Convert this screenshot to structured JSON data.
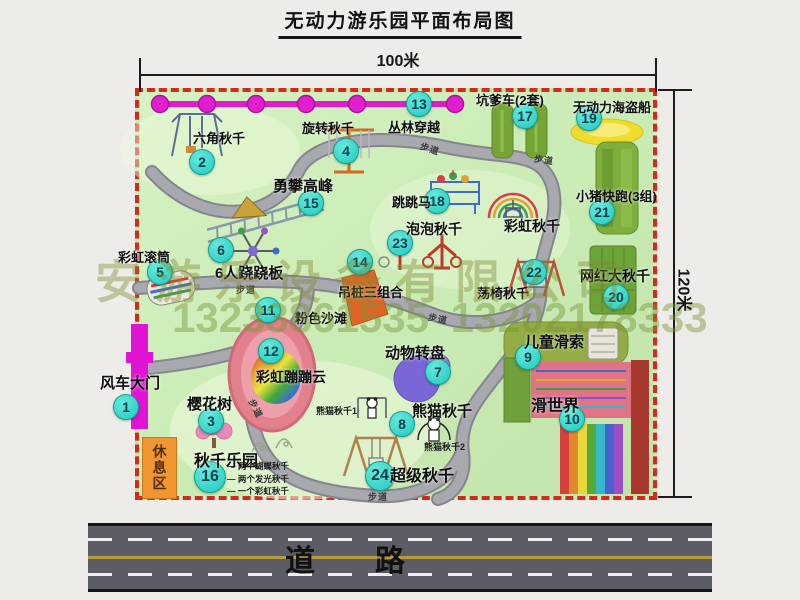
{
  "title": "无动力游乐园平面布局图",
  "dim_top": "100米",
  "dim_right": "120米",
  "road_label": "道　　路",
  "rest_area_label": "休息区",
  "walkway_label": "步道",
  "watermark": {
    "line1": "安游乐设备有限公司",
    "line2": "13233861535 13202178333"
  },
  "colors": {
    "map_green": "#c9ebb4",
    "border_red": "#d22b1e",
    "badge_cyan": "#2fd4c8",
    "chain_magenta": "#e018c8",
    "gate_magenta": "#e113d4",
    "rest_orange": "#f0952f",
    "road_gray": "#5c5c66"
  },
  "attractions": [
    {
      "num": 1,
      "label": "风车大门",
      "lx": 100,
      "ly": 372,
      "bx": 126,
      "by": 407,
      "fs": 15
    },
    {
      "num": 2,
      "label": "六角秋千",
      "lx": 193,
      "ly": 128,
      "bx": 202,
      "by": 162
    },
    {
      "num": 3,
      "label": "樱花树",
      "lx": 187,
      "ly": 393,
      "bx": 211,
      "by": 421,
      "fs": 15
    },
    {
      "num": 4,
      "label": "旋转秋千",
      "lx": 302,
      "ly": 118,
      "bx": 346,
      "by": 151
    },
    {
      "num": 5,
      "label": "彩虹滚筒",
      "lx": 118,
      "ly": 247,
      "bx": 160,
      "by": 272
    },
    {
      "num": 6,
      "label": "6人跷跷板",
      "lx": 215,
      "ly": 262,
      "bx": 221,
      "by": 250,
      "fs": 15
    },
    {
      "num": 7,
      "label": "动物转盘",
      "lx": 385,
      "ly": 342,
      "bx": 438,
      "by": 372,
      "fs": 15
    },
    {
      "num": 8,
      "label": "熊猫秋千",
      "lx": 412,
      "ly": 400,
      "bx": 402,
      "by": 424,
      "fs": 15
    },
    {
      "num": 9,
      "label": "儿童滑索",
      "lx": 524,
      "ly": 331,
      "bx": 528,
      "by": 357,
      "fs": 15
    },
    {
      "num": 10,
      "label": "滑世界",
      "lx": 531,
      "ly": 392,
      "bx": 572,
      "by": 419,
      "fs": 16
    },
    {
      "num": 11,
      "label": "粉色沙滩",
      "lx": 295,
      "ly": 308,
      "bx": 268,
      "by": 310
    },
    {
      "num": 12,
      "label": "彩虹蹦蹦云",
      "lx": 256,
      "ly": 367,
      "bx": 271,
      "by": 351,
      "fs": 14
    },
    {
      "num": 13,
      "label": "丛林穿越",
      "lx": 388,
      "ly": 117,
      "bx": 419,
      "by": 104
    },
    {
      "num": 14,
      "label": "吊桩三组合",
      "lx": 338,
      "ly": 282,
      "bx": 360,
      "by": 262
    },
    {
      "num": 15,
      "label": "勇攀高峰",
      "lx": 273,
      "ly": 175,
      "bx": 311,
      "by": 203,
      "fs": 15
    },
    {
      "num": 16,
      "label": "秋千乐园",
      "lx": 194,
      "ly": 447,
      "bx": 210,
      "by": 477,
      "fs": 16,
      "bs": 32
    },
    {
      "num": 17,
      "label": "坑爹车(2套)",
      "lx": 476,
      "ly": 90,
      "bx": 525,
      "by": 116
    },
    {
      "num": 18,
      "label": "跳跳马",
      "lx": 392,
      "ly": 192,
      "bx": 437,
      "by": 201
    },
    {
      "num": 19,
      "label": "无动力海盗船",
      "lx": 573,
      "ly": 97,
      "bx": 589,
      "by": 118
    },
    {
      "num": 20,
      "label": "网红大秋千",
      "lx": 580,
      "ly": 266,
      "bx": 616,
      "by": 297,
      "fs": 14
    },
    {
      "num": 21,
      "label": "小猪快跑(3组)",
      "lx": 576,
      "ly": 186,
      "bx": 602,
      "by": 212
    },
    {
      "num": 22,
      "label": "荡椅秋千",
      "lx": 477,
      "ly": 283,
      "bx": 534,
      "by": 272
    },
    {
      "num": 23,
      "label": "泡泡秋千",
      "lx": 406,
      "ly": 219,
      "bx": 400,
      "by": 243,
      "fs": 14
    },
    {
      "num": 24,
      "label": "超级秋千",
      "lx": 390,
      "ly": 462,
      "bx": 380,
      "by": 476,
      "fs": 16,
      "bs": 30
    },
    {
      "num": null,
      "label": "彩虹秋千",
      "lx": 504,
      "ly": 216,
      "fs": 14
    }
  ],
  "walkway_positions": [
    {
      "x": 420,
      "y": 142,
      "rot": 18
    },
    {
      "x": 534,
      "y": 153,
      "rot": 8
    },
    {
      "x": 236,
      "y": 283,
      "rot": 0
    },
    {
      "x": 428,
      "y": 312,
      "rot": 12
    },
    {
      "x": 246,
      "y": 402,
      "rot": 62
    },
    {
      "x": 368,
      "y": 490,
      "rot": 0
    }
  ],
  "notes": {
    "panda1": {
      "text": "熊猫秋千1",
      "x": 316,
      "y": 404
    },
    "panda2": {
      "text": "熊猫秋千2",
      "x": 424,
      "y": 440
    },
    "swing_park": {
      "x": 227,
      "y": 460,
      "items": [
        "两个蝴蝶秋千",
        "两个发光秋千",
        "一个彩虹秋千"
      ]
    }
  }
}
